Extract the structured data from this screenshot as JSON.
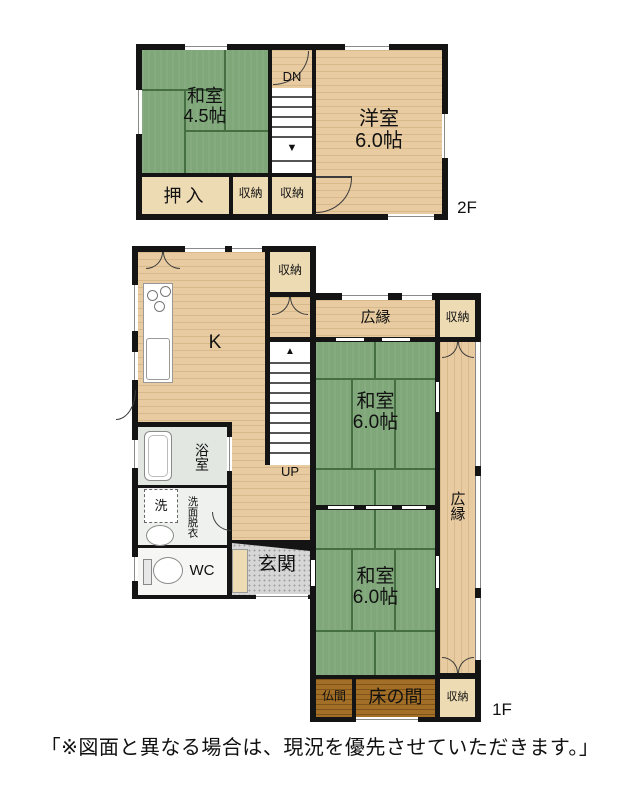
{
  "floor2": {
    "floor_label": "2F",
    "washitsu": {
      "name": "和室",
      "size": "4.5帖"
    },
    "stairs_label": "DN",
    "stairs_arrow": "▼",
    "youshitsu": {
      "name": "洋室",
      "size": "6.0帖"
    },
    "oshiire": "押入",
    "closet_a": "収納",
    "closet_b": "収納"
  },
  "floor1": {
    "floor_label": "1F",
    "kitchen": "K",
    "closet_nw": "収納",
    "veranda_top": "広縁",
    "closet_ne": "収納",
    "washitsu_upper": {
      "name": "和室",
      "size": "6.0帖"
    },
    "veranda_right": "広縁",
    "stairs_label": "UP",
    "stairs_arrow": "▲",
    "bathroom": "浴室",
    "washer": "洗",
    "dressing_room": "洗面脱衣",
    "toilet": "WC",
    "entrance": "玄関",
    "washitsu_lower": {
      "name": "和室",
      "size": "6.0帖"
    },
    "butsuma": "仏間",
    "tokonoma": "床の間",
    "closet_se": "収納"
  },
  "disclaimer": "「※図面と異なる場合は、現況を優先させていただきます。」",
  "colors": {
    "tatami": "#7fa77a",
    "wood": "#e8cba0",
    "closet": "#eddbb4",
    "alcove": "#a36f26",
    "wall": "#141414"
  }
}
